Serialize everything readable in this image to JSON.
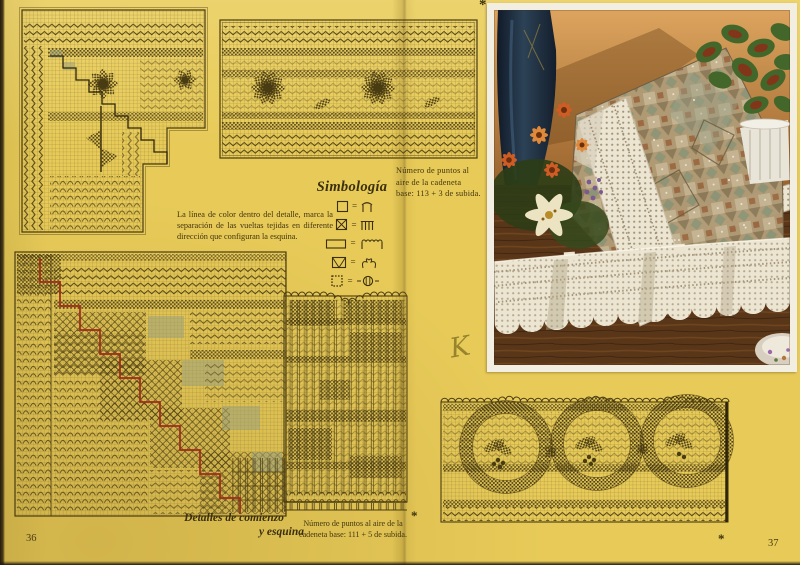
{
  "page": {
    "left_number": "36",
    "right_number": "37",
    "background_color": "#e7ca58"
  },
  "texts": {
    "symbology_title": "Simbología",
    "equals": "=",
    "color_line_note": "La línea de color dentro del detalle, marca la separación de las vueltas tejidas en diferente dirección que configuran la esquina.",
    "base_chain_note_top": [
      "Número de puntos al",
      "aire de la cadeneta",
      "base: 113 + 3 de subida."
    ],
    "base_chain_note_bottom": [
      "Número de puntos al aire de la",
      "cadeneta base: 111 + 5 de subida."
    ],
    "detail_caption": [
      "Detalles de comienzo",
      "y esquina"
    ],
    "handwritten_mark": "K",
    "asterisk": "*"
  },
  "legend": {
    "items": [
      {
        "square": "open-square",
        "stitch": "two-posts-chain-arch"
      },
      {
        "square": "crossed-square",
        "stitch": "four-posts"
      },
      {
        "square": "wide-rectangle",
        "stitch": "posts-with-chain-loops"
      },
      {
        "square": "v-square",
        "stitch": "fan-arch-pair"
      },
      {
        "square": "dotted-square",
        "stitch": "popcorn-in-arches"
      }
    ]
  },
  "charts": [
    {
      "id": "corner-top-left",
      "motif": "daisy-corner-filet-chart"
    },
    {
      "id": "border-top-center",
      "motif": "daisy-border-filet-chart"
    },
    {
      "id": "corner-bottom-left",
      "motif": "corner-working-detail-chart-red-line"
    },
    {
      "id": "edging-vertical-center",
      "motif": "scalloped-edging-filet-chart"
    },
    {
      "id": "border-bottom-right",
      "motif": "wreath-border-filet-chart"
    }
  ],
  "photo": {
    "subject": "tapestry-cushion-with-filet-lace-border-flowers-and-lace-edging-on-wood-table"
  }
}
